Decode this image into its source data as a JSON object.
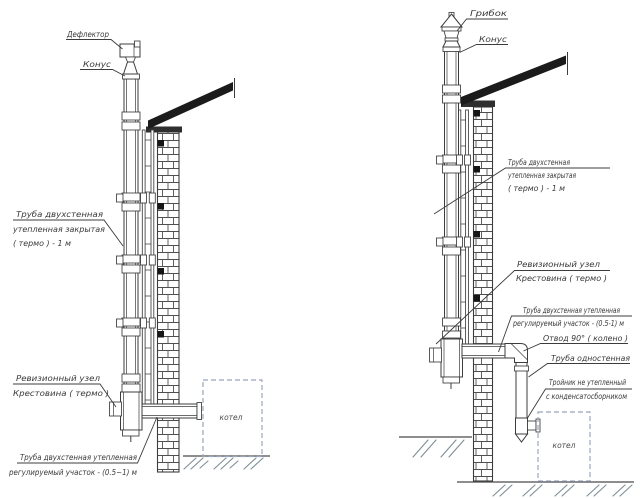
{
  "colors": {
    "line": "#3c3c3c",
    "roof": "#1b1b1b",
    "boiler_dash": "#9aa5bf",
    "ground_hatch": "#7d8e94",
    "label_text": "#3a3a3a"
  },
  "left": {
    "deflector": "Дефлектор",
    "cone": "Конус",
    "pipe1": "Труба двухстенная",
    "pipe2": "утепленная закрытая",
    "pipe3": "( термо ) - 1 м",
    "revision1": "Ревизионный узел",
    "revision2": "Крестовина ( термо )",
    "adjust1": "Труба двухстенная утепленная",
    "adjust2": "регулируемый участок - (0.5~1) м",
    "boiler": "котел"
  },
  "right": {
    "cap": "Грибок",
    "cone": "Конус",
    "pipe1": "Труба двухстенная",
    "pipe2": "утепленная закрытая",
    "pipe3": "( термо ) - 1 м",
    "revision1": "Ревизионный узел",
    "revision2": "Крестовина ( термо )",
    "adjust1": "Труба двухстенная утепленная",
    "adjust2": "регулируемый участок - (0.5-1) м",
    "elbow": "Отвод 90° ( колено )",
    "single_pipe": "Труба одностенная",
    "tee1": "Тройник не утепленный",
    "tee2": "с конденсатосборником",
    "boiler": "котел"
  }
}
